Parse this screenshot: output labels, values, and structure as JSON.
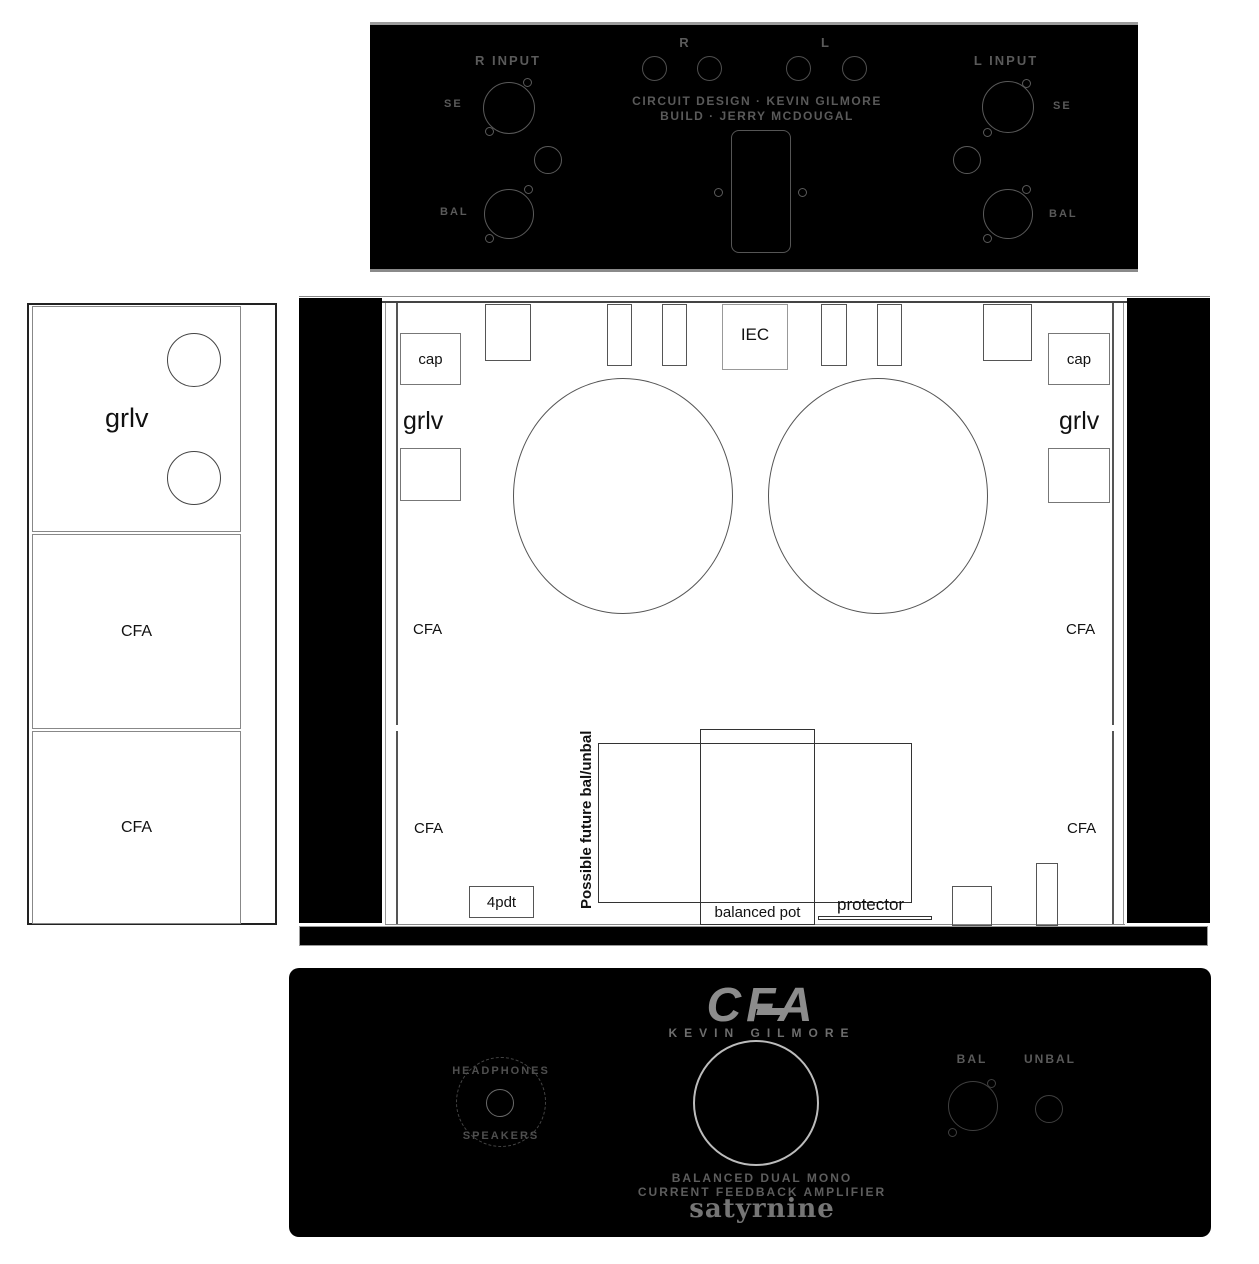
{
  "rear_panel": {
    "r_channel_label": "R",
    "l_channel_label": "L",
    "r_input_label": "R INPUT",
    "l_input_label": "L INPUT",
    "se_label": "SE",
    "bal_label": "BAL",
    "credit_line1": "CIRCUIT DESIGN · KEVIN GILMORE",
    "credit_line2": "BUILD · JERRY MCDOUGAL"
  },
  "side_view": {
    "grlv_label": "grlv",
    "cfa_label": "CFA"
  },
  "top_view": {
    "cap_label": "cap",
    "grlv_label": "grlv",
    "cfa_label": "CFA",
    "iec_label": "IEC",
    "future_note": "Possible future bal/unbal",
    "pot_label": "balanced pot",
    "protector_label": "protector",
    "switch_label": "4pdt"
  },
  "front_panel": {
    "logo": "CFA",
    "designer": "KEVIN GILMORE",
    "headphones_label": "HEADPHONES",
    "speakers_label": "SPEAKERS",
    "bal_label": "BAL",
    "unbal_label": "UNBAL",
    "tagline1": "BALANCED DUAL MONO",
    "tagline2": "CURRENT FEEDBACK AMPLIFIER",
    "brand": "satyrnine"
  },
  "colors": {
    "panel_black": "#000000",
    "outline_gray": "#555555",
    "panel_text_gray": "#5a5a5a",
    "logo_gray": "#8c8c8c",
    "knob_stroke": "#bcbcbc",
    "drawing_ink": "#111111"
  }
}
